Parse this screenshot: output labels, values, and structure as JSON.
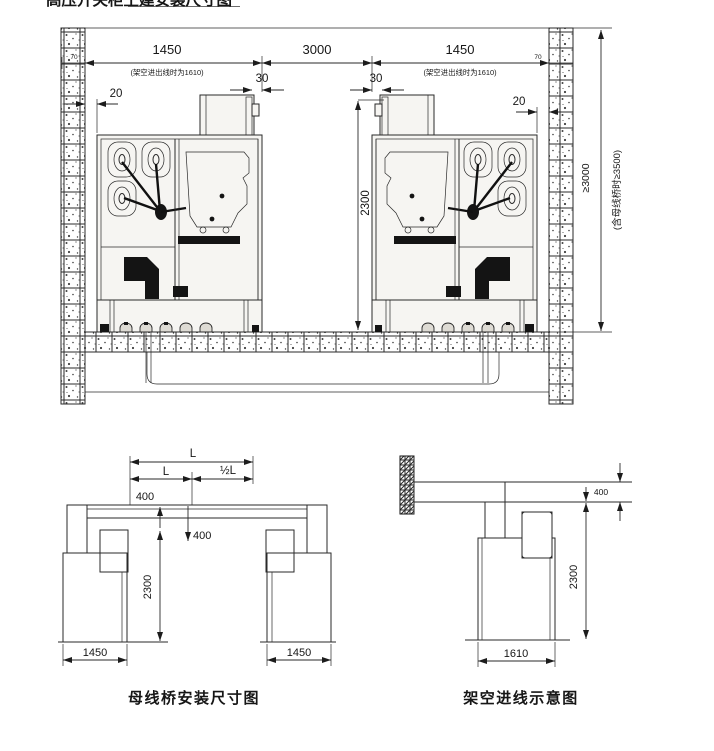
{
  "page": {
    "clipped_title": "高压开关柜土建安装尺寸图"
  },
  "top": {
    "dims": {
      "wall_left": "70",
      "depth_left": "1450",
      "depth_left_note": "(架空进出线时为1610)",
      "gap20_left": "20",
      "gap30_left": "30",
      "aisle": "3000",
      "gap30_right": "30",
      "depth_right": "1450",
      "depth_right_note": "(架空进出线时为1610)",
      "wall_right": "70",
      "gap20_right": "20",
      "cabinet_height": "2300",
      "room_height": "≥3000",
      "room_height_note": "(含母线桥时≥3500)"
    }
  },
  "busbar": {
    "caption": "母线桥安装尺寸图",
    "dims": {
      "span_total": "L",
      "span_left": "L",
      "span_half": "½L",
      "rise": "400",
      "drop": "400",
      "height": "2300",
      "width_left": "1450",
      "width_right": "1450"
    }
  },
  "overhead": {
    "caption": "架空进线示意图",
    "dims": {
      "beam_height": "400",
      "height": "2300",
      "width": "1610"
    }
  }
}
